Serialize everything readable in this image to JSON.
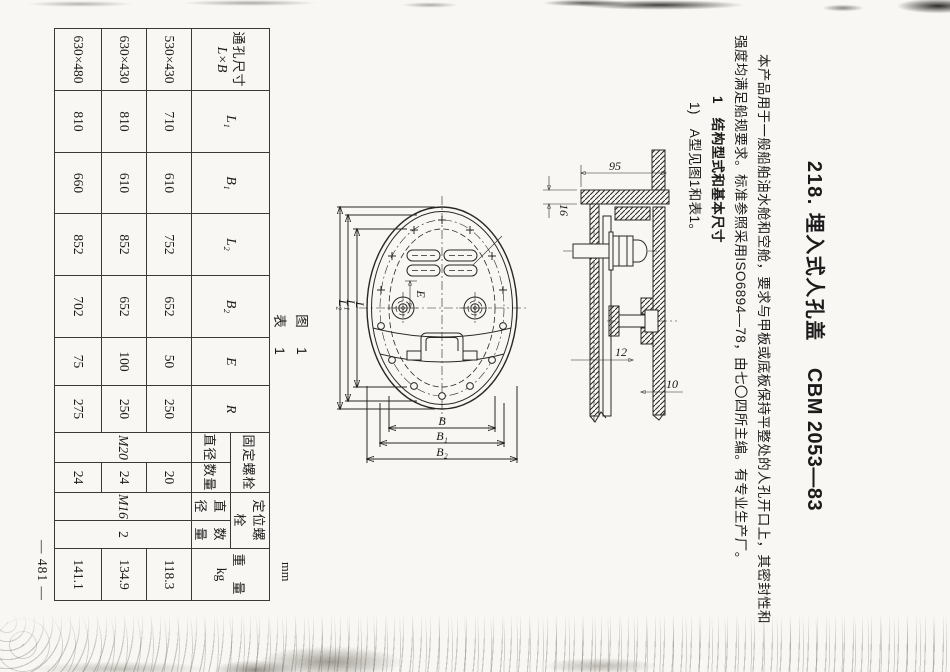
{
  "title": {
    "left": "218. 埋入式人孔盖",
    "code": "CBM 2053—83"
  },
  "intro": {
    "line1": "本产品用于一般船舶油水舱和空舱，要求与甲板或底板保持平整处的人孔开口上，其密封性和",
    "line2": "强度均满足船规要求。标准参照采用ISO6894—78，由七〇四所主编。有专业生产厂。"
  },
  "section": {
    "heading": "1　结构型式和基本尺寸",
    "item": "1)　A型见图1和表1。"
  },
  "captions": {
    "figure": "图　1",
    "table": "表　1",
    "unit": "mm",
    "page_number": "— 481 —"
  },
  "drawing": {
    "dim_95": "95",
    "dim_16": "16",
    "dim_12": "12",
    "dim_10": "10",
    "dim_L": "L",
    "dim_L1": "L₁",
    "dim_L2": "L₂",
    "dim_B": "B",
    "dim_B1": "B₁",
    "dim_B2": "B₂",
    "dim_E": "E"
  },
  "table": {
    "headers": {
      "size_top": "通孔尺寸",
      "size_bottom": "L×B",
      "L1": "L₁",
      "B1": "B₁",
      "L2": "L₂",
      "B2": "B₂",
      "E": "E",
      "R": "R",
      "fix_bolt": "固定螺栓",
      "pos_bolt": "定位螺栓",
      "dia": "直径",
      "qty": "数量",
      "dia2": "直径",
      "qty2": "数量",
      "weight_top": "重　量",
      "weight_unit": "kg"
    },
    "rows": [
      [
        "530×430",
        "710",
        "610",
        "752",
        "652",
        "50",
        "250",
        "M20",
        "20",
        "M16",
        "2",
        "118.3"
      ],
      [
        "630×430",
        "810",
        "610",
        "852",
        "652",
        "100",
        "250",
        "24",
        "134.9"
      ],
      [
        "630×480",
        "810",
        "660",
        "852",
        "702",
        "75",
        "275",
        "24",
        "141.1"
      ]
    ]
  }
}
